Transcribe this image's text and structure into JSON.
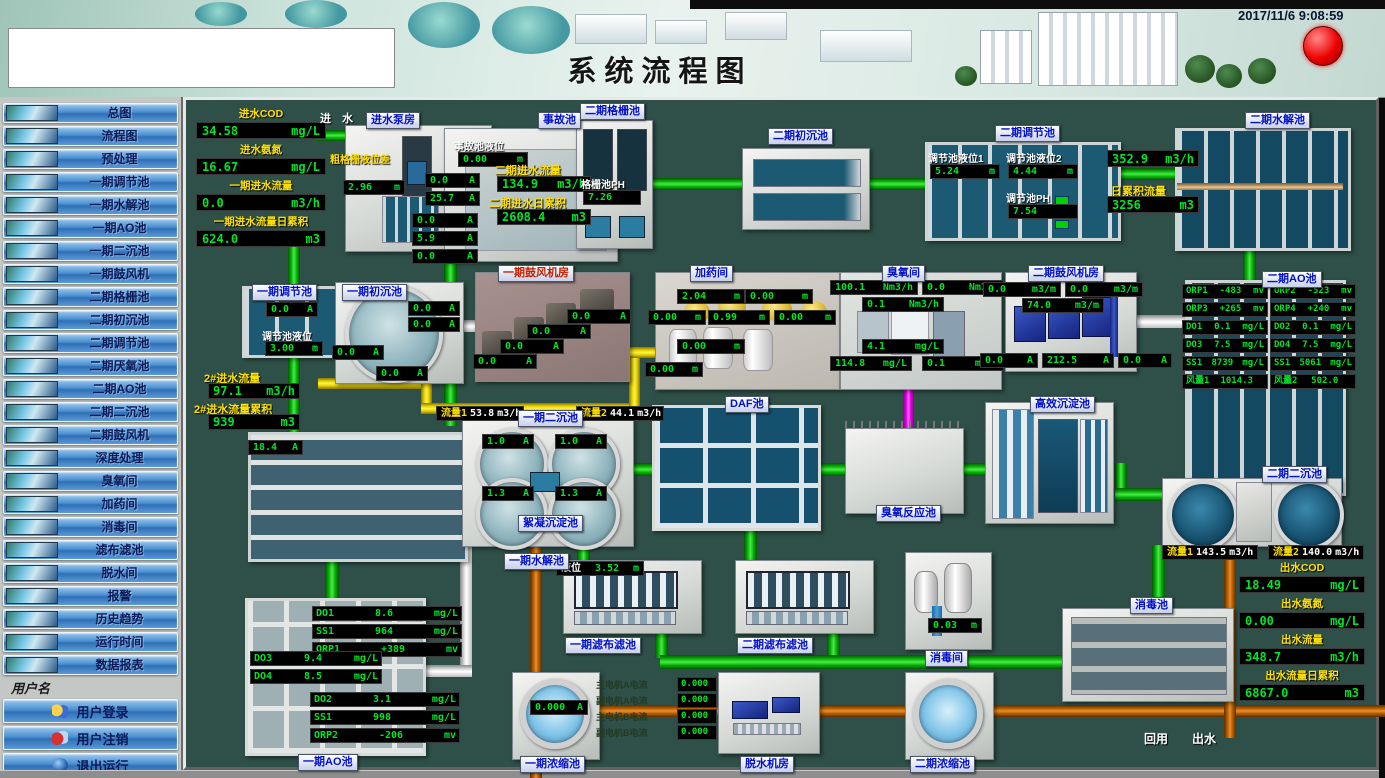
{
  "header": {
    "title": "系统流程图",
    "datetime": "2017/11/6 9:08:59"
  },
  "sidebar": {
    "nav_items": [
      "总图",
      "流程图",
      "预处理",
      "一期调节池",
      "一期水解池",
      "一期AO池",
      "一期二沉池",
      "一期鼓风机",
      "二期格栅池",
      "二期初沉池",
      "二期调节池",
      "二期厌氧池",
      "二期AO池",
      "二期二沉池",
      "二期鼓风机",
      "深度处理",
      "臭氧间",
      "加药间",
      "消毒间",
      "滤布滤池",
      "脱水间",
      "报警",
      "历史趋势",
      "运行时间",
      "数据报表"
    ],
    "username_label": "用户名",
    "login": "用户登录",
    "logout": "用户注销",
    "exit": "退出运行",
    "company": "山东新日电气设备有限公司"
  },
  "colors": {
    "bg": "#2e5048",
    "pipe_green": "#0ab00a",
    "pipe_yellow": "#e8d400",
    "pipe_orange": "#b86000",
    "pipe_magenta": "#e400e4",
    "readout_green": "#00e42a",
    "label_yellow": "#ffe000",
    "badge_blue": "#0010c8",
    "alarm_red": "#ee0000"
  },
  "inlet": {
    "flow_label": "进 水",
    "stats": [
      {
        "label": "进水COD",
        "v": "34.58",
        "u": "mg/L"
      },
      {
        "label": "进水氨氮",
        "v": "16.67",
        "u": "mg/L"
      },
      {
        "label": "一期进水流量",
        "v": "0.0",
        "u": "m3/h"
      },
      {
        "label": "一期进水流量日累积",
        "v": "624.0",
        "u": "m3"
      }
    ]
  },
  "pump_house": {
    "badge": "进水泵房",
    "level_label": "粗格栅液位差",
    "level": {
      "v": "2.96",
      "u": "m"
    },
    "currents": [
      {
        "v": "0.0",
        "u": "A"
      },
      {
        "v": "25.7",
        "u": "A"
      },
      {
        "v": "0.0",
        "u": "A"
      },
      {
        "v": "5.9",
        "u": "A"
      },
      {
        "v": "0.0",
        "u": "A"
      }
    ]
  },
  "accident": {
    "badge": "事故池",
    "level_label": "事故池液位",
    "level": {
      "v": "0.00",
      "u": "m"
    },
    "flow_label": "二期进水流量",
    "flow": {
      "v": "134.9",
      "u": "m3/h"
    },
    "total_label": "二期进水日累积",
    "total": {
      "v": "2608.4",
      "u": "m3"
    }
  },
  "grille2": {
    "badge": "二期格栅池",
    "ph_label": "格栅池PH",
    "ph": "7.26"
  },
  "primary2": {
    "badge": "二期初沉池"
  },
  "regulate2": {
    "badge": "二期调节池",
    "lvl1_label": "调节池液位1",
    "lvl1": {
      "v": "5.24",
      "u": "m"
    },
    "lvl2_label": "调节池液位2",
    "lvl2": {
      "v": "4.44",
      "u": "m"
    },
    "ph_label": "调节池PH",
    "ph": "7.54"
  },
  "flow_east": {
    "flow": {
      "v": "352.9",
      "u": "m3/h"
    },
    "total_label": "日累积流量",
    "total": {
      "v": "3256",
      "u": "m3"
    }
  },
  "hydrolysis2": {
    "badge": "二期水解池"
  },
  "regulate1": {
    "badge": "一期调节池",
    "current": {
      "v": "0.0",
      "u": "A"
    },
    "lvl_label": "调节池液位",
    "lvl": {
      "v": "3.00",
      "u": "m"
    }
  },
  "primary1": {
    "badge": "一期初沉池",
    "currents": [
      {
        "v": "0.0",
        "u": "A"
      },
      {
        "v": "0.0",
        "u": "A"
      },
      {
        "v": "0.0",
        "u": "A"
      },
      {
        "v": "0.0",
        "u": "A"
      }
    ]
  },
  "flow2": {
    "flow_label": "2#进水流量",
    "flow": {
      "v": "97.1",
      "u": "m3/h"
    },
    "total_label": "2#进水流量累积",
    "total": {
      "v": "939",
      "u": "m3"
    }
  },
  "blower1": {
    "badge": "一期鼓风机房",
    "currents": [
      {
        "v": "0.0",
        "u": "A"
      },
      {
        "v": "0.0",
        "u": "A"
      },
      {
        "v": "0.0",
        "u": "A"
      },
      {
        "v": "0.0",
        "u": "A"
      }
    ]
  },
  "dosing": {
    "badge": "加药间",
    "levels": [
      {
        "v": "2.04",
        "u": "m"
      },
      {
        "v": "0.00",
        "u": "m"
      },
      {
        "v": "0.00",
        "u": "m"
      },
      {
        "v": "0.99",
        "u": "m"
      },
      {
        "v": "0.00",
        "u": "m"
      },
      {
        "v": "0.00",
        "u": "m"
      },
      {
        "v": "0.00",
        "u": "m"
      }
    ]
  },
  "ozone_room": {
    "badge": "臭氧间",
    "readouts": [
      {
        "v": "100.1",
        "u": "Nm3/h"
      },
      {
        "v": "0.0",
        "u": "Nm3/h"
      },
      {
        "v": "0.1",
        "u": "Nm3/h"
      },
      {
        "v": "4.1",
        "u": "mg/L"
      },
      {
        "v": "114.8",
        "u": "mg/L"
      },
      {
        "v": "0.1",
        "u": "mg/L"
      }
    ]
  },
  "blower2": {
    "badge": "二期鼓风机房",
    "flows": [
      {
        "v": "0.0",
        "u": "m3/m"
      },
      {
        "v": "0.0",
        "u": "m3/m"
      },
      {
        "v": "74.0",
        "u": "m3/m"
      }
    ],
    "currents": [
      {
        "v": "0.0",
        "u": "A"
      },
      {
        "v": "212.5",
        "u": "A"
      },
      {
        "v": "0.0",
        "u": "A"
      }
    ]
  },
  "ao2": {
    "badge": "二期AO池",
    "left": [
      {
        "l": "ORP1",
        "v": "-483",
        "u": "mv"
      },
      {
        "l": "ORP3",
        "v": "+265",
        "u": "mv"
      },
      {
        "l": "DO1",
        "v": "0.1",
        "u": "mg/L"
      },
      {
        "l": "DO3",
        "v": "7.5",
        "u": "mg/L"
      },
      {
        "l": "SS1",
        "v": "8739",
        "u": "mg/L"
      },
      {
        "l": "风量1",
        "v": "1014.3",
        "u": ""
      }
    ],
    "right": [
      {
        "l": "ORP2",
        "v": "-523",
        "u": "mv"
      },
      {
        "l": "ORP4",
        "v": "+240",
        "u": "mv"
      },
      {
        "l": "DO2",
        "v": "0.1",
        "u": "mg/L"
      },
      {
        "l": "DO4",
        "v": "7.5",
        "u": "mg/L"
      },
      {
        "l": "SS1",
        "v": "5061",
        "u": "mg/L"
      },
      {
        "l": "风量2",
        "v": "502.0",
        "u": ""
      }
    ]
  },
  "hydrolysis1": {
    "badge": "一期水解池",
    "current": {
      "v": "18.4",
      "u": "A"
    }
  },
  "secondary1": {
    "badge": "一期二沉池",
    "sub_badge": "絮凝沉淀池",
    "flow1_label": "流量1",
    "flow1": {
      "v": "53.8",
      "u": "m3/h"
    },
    "flow2_label": "流量2",
    "flow2": {
      "v": "44.1",
      "u": "m3/h"
    },
    "currents": [
      {
        "v": "1.0",
        "u": "A"
      },
      {
        "v": "1.0",
        "u": "A"
      },
      {
        "v": "1.3",
        "u": "A"
      },
      {
        "v": "1.3",
        "u": "A"
      }
    ]
  },
  "daf": {
    "badge": "DAF池"
  },
  "ozone_reactor": {
    "badge": "臭氧反应池"
  },
  "high_eff": {
    "badge": "高效沉淀池"
  },
  "secondary2": {
    "badge": "二期二沉池",
    "flow1_label": "流量1",
    "flow1": {
      "v": "143.5",
      "u": "m3/h"
    },
    "flow2_label": "流量2",
    "flow2": {
      "v": "140.0",
      "u": "m3/h"
    }
  },
  "outlet": {
    "stats": [
      {
        "label": "出水COD",
        "v": "18.49",
        "u": "mg/L"
      },
      {
        "label": "出水氨氮",
        "v": "0.00",
        "u": "mg/L"
      },
      {
        "label": "出水流量",
        "v": "348.7",
        "u": "m3/h"
      },
      {
        "label": "出水流量日累积",
        "v": "6867.0",
        "u": "m3"
      }
    ]
  },
  "ao1": {
    "badge": "一期AO池",
    "top": [
      {
        "l": "DO1",
        "v": "8.6",
        "u": "mg/L"
      },
      {
        "l": "SS1",
        "v": "964",
        "u": "mg/L"
      },
      {
        "l": "ORP1",
        "v": "+389",
        "u": "mv"
      }
    ],
    "mid": [
      {
        "l": "DO3",
        "v": "9.4",
        "u": "mg/L"
      },
      {
        "l": "DO4",
        "v": "8.5",
        "u": "mg/L"
      }
    ],
    "bottom": [
      {
        "l": "DO2",
        "v": "3.1",
        "u": "mg/L"
      },
      {
        "l": "SS1",
        "v": "998",
        "u": "mg/L"
      },
      {
        "l": "ORP2",
        "v": "-206",
        "u": "mv"
      }
    ]
  },
  "cloth1": {
    "badge": "一期滤布滤池",
    "level_label": "液位",
    "level": {
      "v": "3.52",
      "u": "m"
    }
  },
  "cloth2": {
    "badge": "二期滤布滤池"
  },
  "disinfect_room": {
    "badge": "消毒间",
    "level": {
      "v": "0.03",
      "u": "m"
    }
  },
  "disinfect_tank": {
    "badge": "消毒池"
  },
  "thickener1": {
    "badge": "一期浓缩池",
    "current": {
      "v": "0.000",
      "u": "A"
    }
  },
  "dewater": {
    "badge": "脱水机房",
    "motors": [
      {
        "label": "主电机A电流",
        "v": "0.000"
      },
      {
        "label": "副电机A电流",
        "v": "0.000"
      },
      {
        "label": "主电机B电流",
        "v": "0.000"
      },
      {
        "label": "副电机B电流",
        "v": "0.000"
      }
    ]
  },
  "thickener2": {
    "badge": "二期浓缩池"
  },
  "reuse_label": "回用",
  "outflow_label": "出水"
}
